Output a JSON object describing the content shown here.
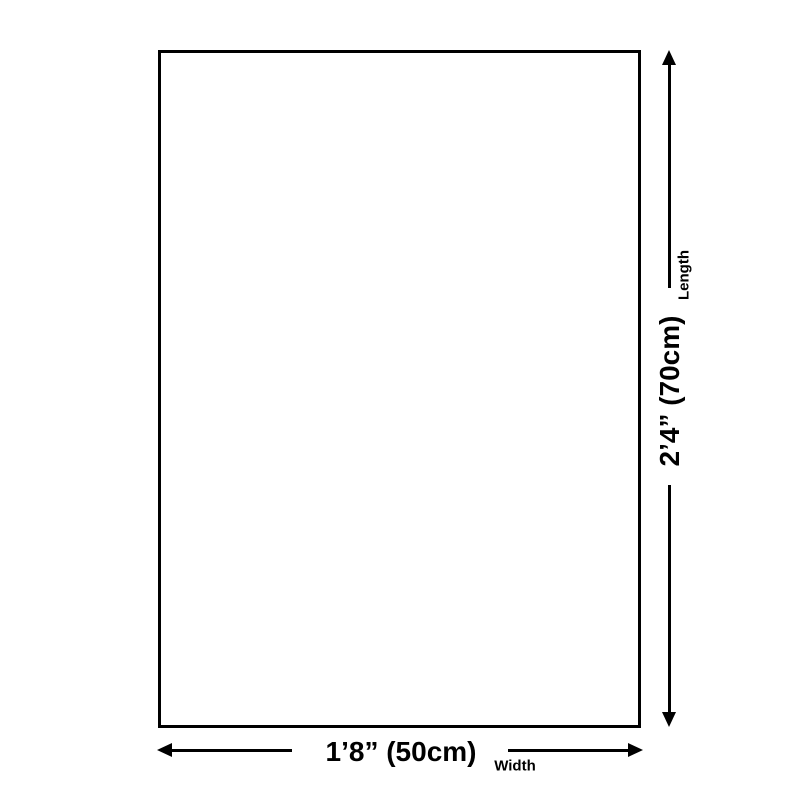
{
  "canvas": {
    "background_color": "#ffffff",
    "ink_color": "#000000"
  },
  "diagram": {
    "shape": "rectangle",
    "length": {
      "value": "2’4” (70cm)",
      "caption": "Length"
    },
    "width": {
      "value": "1’8” (50cm)",
      "caption": "Width"
    }
  }
}
